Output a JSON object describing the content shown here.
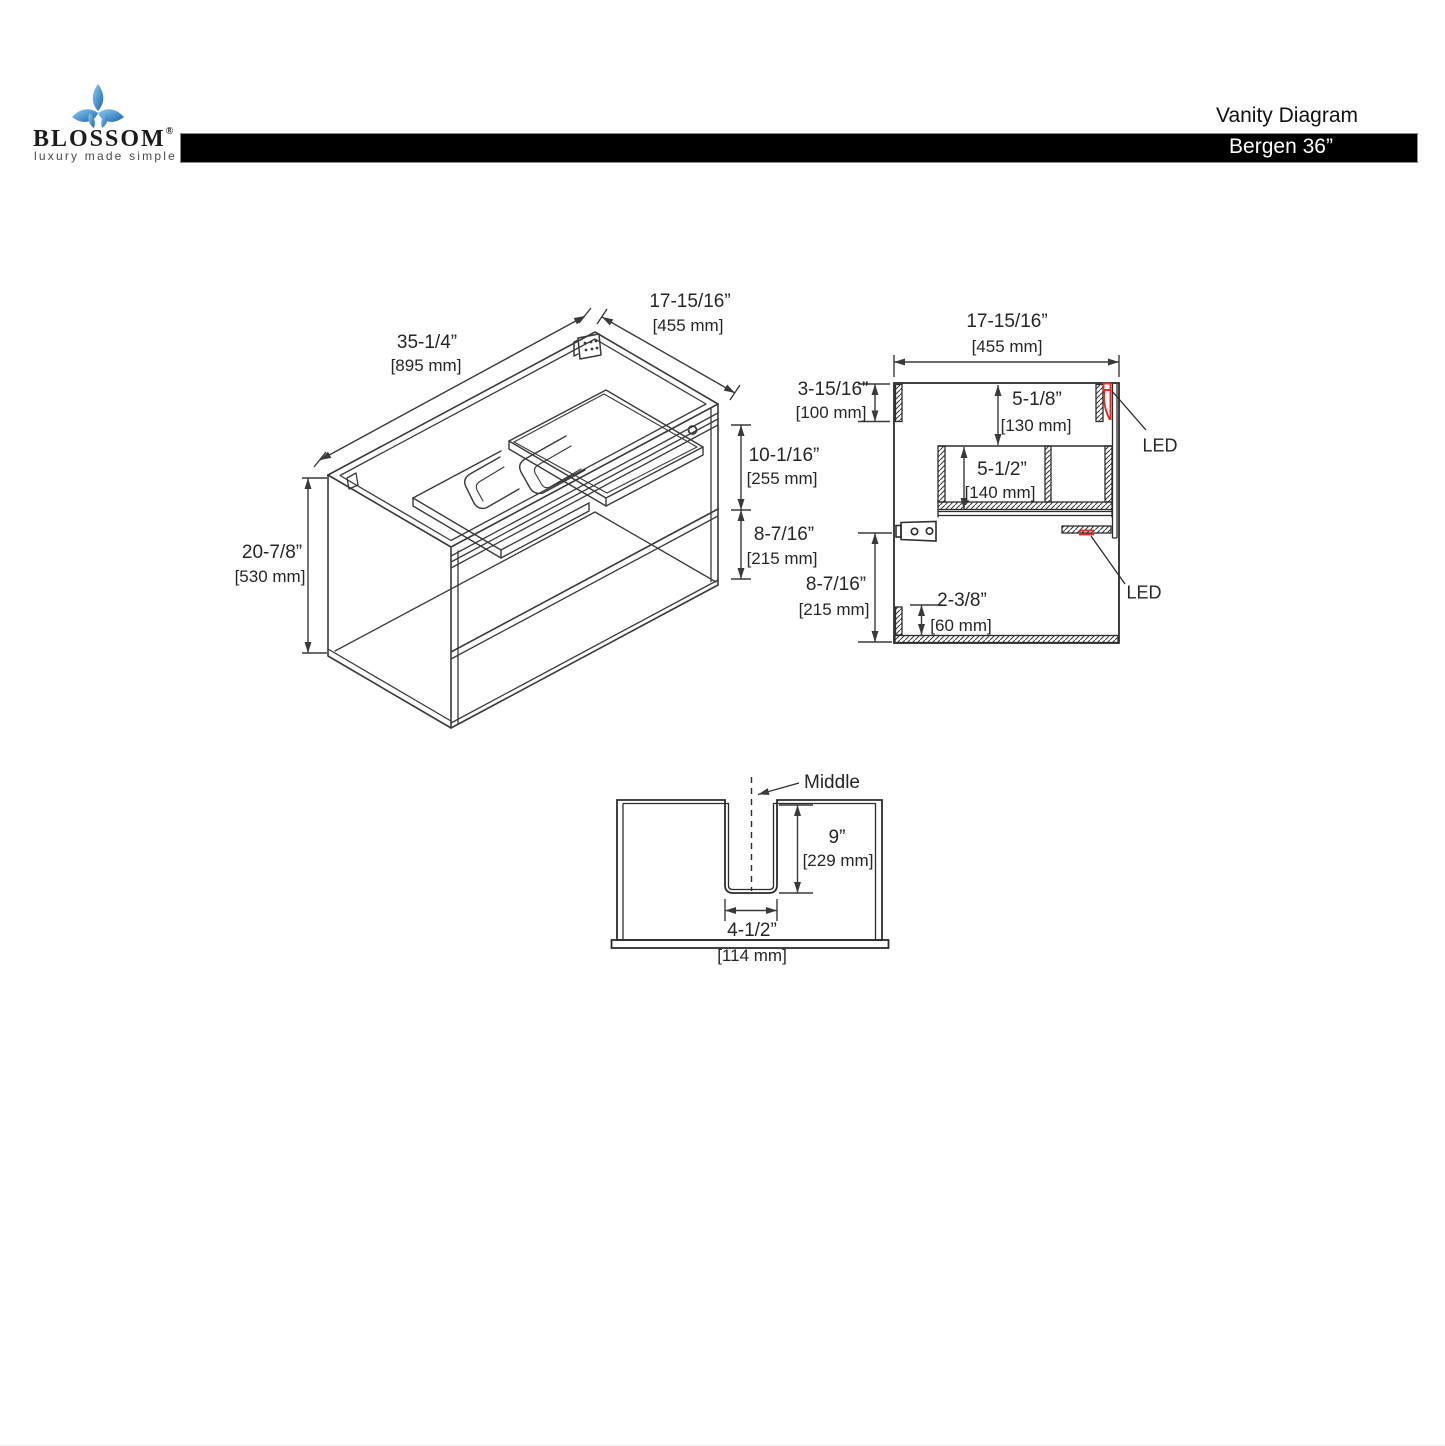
{
  "header": {
    "brand": "BLOSSOM",
    "brand_reg": "®",
    "tagline": "luxury made simple",
    "doc_title": "Vanity Diagram",
    "model": "Bergen 36”",
    "bar_color": "#000000"
  },
  "colors": {
    "line": "#3a3a3a",
    "text": "#262626",
    "led_accent": "#d9312a",
    "logo_blue_light": "#8fd0f2",
    "logo_blue_dark": "#1b61ad"
  },
  "views": {
    "isometric": {
      "title": "isometric-cabinet-view",
      "dims": {
        "width": {
          "in": "35-1/4”",
          "mm": "[895 mm]"
        },
        "depth": {
          "in": "17-15/16”",
          "mm": "[455 mm]"
        },
        "height": {
          "in": "20-7/8”",
          "mm": "[530 mm]"
        },
        "drawer_zone": {
          "in": "10-1/16”",
          "mm": "[255 mm]"
        },
        "shelf_zone": {
          "in": "8-7/16”",
          "mm": "[215 mm]"
        }
      }
    },
    "side": {
      "title": "side-section-view",
      "dims": {
        "depth": {
          "in": "17-15/16”",
          "mm": "[455 mm]"
        },
        "top_gap": {
          "in": "3-15/16”",
          "mm": "[100 mm]"
        },
        "drawer_top": {
          "in": "5-1/8”",
          "mm": "[130 mm]"
        },
        "drawer_inner": {
          "in": "5-1/2”",
          "mm": "[140 mm]"
        },
        "bottom_gap": {
          "in": "8-7/16”",
          "mm": "[215 mm]"
        },
        "toe_kick": {
          "in": "2-3/8”",
          "mm": "[60 mm]"
        }
      },
      "led_label": "LED"
    },
    "bottom": {
      "title": "back-panel-cutout-view",
      "middle_label": "Middle",
      "dims": {
        "notch_depth": {
          "in": "9”",
          "mm": "[229 mm]"
        },
        "notch_width": {
          "in": "4-1/2”",
          "mm": "[114 mm]"
        }
      }
    }
  }
}
